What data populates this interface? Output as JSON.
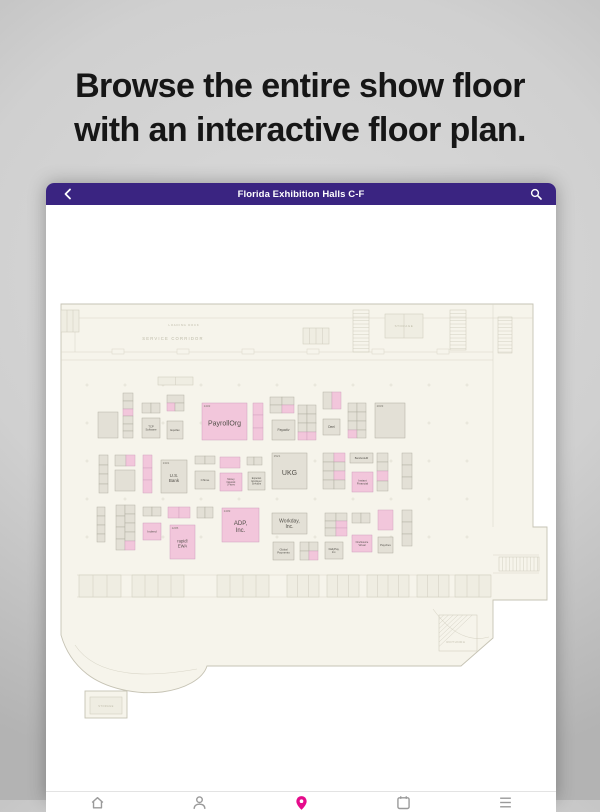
{
  "marketing": {
    "headline_line1": "Browse the entire show floor",
    "headline_line2": "with an interactive floor plan."
  },
  "app": {
    "title": "Florida Exhibition Halls C-F",
    "header_color": "#3a2481"
  },
  "bottom_nav": {
    "items": [
      {
        "name": "home",
        "active": false
      },
      {
        "name": "profile",
        "active": false
      },
      {
        "name": "map-pin",
        "active": true
      },
      {
        "name": "schedule",
        "active": false
      },
      {
        "name": "more",
        "active": false
      }
    ],
    "active_color": "#e50c8b",
    "inactive_color": "#9a9a9a"
  },
  "floorplan": {
    "colors": {
      "floor": "#f6f4eb",
      "wall": "#c6c3b4",
      "inner_line": "#d9d6c8",
      "room_line": "#cfccbd",
      "booth_gray": "#e3e0d6",
      "booth_gray_stroke": "#aeab9f",
      "booth_pink": "#f2c6db",
      "booth_pink_stroke": "#cf9fbd",
      "booth_text": "#53504a",
      "num_text": "#78756c",
      "corridor_text": "#bdbaa8"
    },
    "outline": "M 4 7 L 476 7 L 476 230 L 490 230 L 490 303 L 436 303 L 436 341 L 404 369 L 150 369 C 146 382 128 392 105 395 C 78 398 48 391 30 377 C 16 366 8 352 4 338 Z",
    "leg": {
      "x": 28,
      "y": 394,
      "w": 42,
      "h": 27
    },
    "lines": [
      {
        "x1": 4,
        "y1": 21,
        "x2": 476,
        "y2": 21
      },
      {
        "x1": 4,
        "y1": 55,
        "x2": 436,
        "y2": 55
      },
      {
        "x1": 4,
        "y1": 63,
        "x2": 436,
        "y2": 63
      },
      {
        "x1": 436,
        "y1": 7,
        "x2": 436,
        "y2": 230
      },
      {
        "x1": 18,
        "y1": 21,
        "x2": 18,
        "y2": 55
      },
      {
        "x1": 20,
        "y1": 278,
        "x2": 434,
        "y2": 278
      },
      {
        "x1": 20,
        "y1": 300,
        "x2": 434,
        "y2": 300
      },
      {
        "x1": 436,
        "y1": 258,
        "x2": 482,
        "y2": 258
      },
      {
        "x1": 436,
        "y1": 276,
        "x2": 482,
        "y2": 276
      }
    ],
    "doors": [
      {
        "x": 55,
        "y": 52
      },
      {
        "x": 120,
        "y": 52
      },
      {
        "x": 185,
        "y": 52
      },
      {
        "x": 250,
        "y": 52
      },
      {
        "x": 315,
        "y": 52
      },
      {
        "x": 380,
        "y": 52
      }
    ],
    "rooms": [
      {
        "x": 4,
        "y": 13,
        "w": 18,
        "h": 22,
        "sub": 2
      },
      {
        "x": 101,
        "y": 80,
        "w": 35,
        "h": 8,
        "sub": 1
      },
      {
        "x": 246,
        "y": 31,
        "w": 26,
        "h": 16,
        "sub": 3
      },
      {
        "x": 328,
        "y": 17,
        "w": 38,
        "h": 24,
        "sub": 1
      },
      {
        "x": 22,
        "y": 278,
        "w": 42,
        "h": 22,
        "sub": 2
      },
      {
        "x": 75,
        "y": 278,
        "w": 52,
        "h": 22,
        "sub": 3
      },
      {
        "x": 160,
        "y": 278,
        "w": 52,
        "h": 22,
        "sub": 3
      },
      {
        "x": 230,
        "y": 278,
        "w": 32,
        "h": 22,
        "sub": 2
      },
      {
        "x": 270,
        "y": 278,
        "w": 32,
        "h": 22,
        "sub": 2
      },
      {
        "x": 310,
        "y": 278,
        "w": 42,
        "h": 22,
        "sub": 3
      },
      {
        "x": 360,
        "y": 278,
        "w": 32,
        "h": 22,
        "sub": 2
      },
      {
        "x": 398,
        "y": 278,
        "w": 36,
        "h": 22,
        "sub": 2
      },
      {
        "x": 33,
        "y": 400,
        "w": 32,
        "h": 17,
        "sub": 0
      }
    ],
    "stairs": [
      {
        "x": 296,
        "y": 13,
        "w": 16,
        "h": 42,
        "dir": "h",
        "step": 3.5
      },
      {
        "x": 441,
        "y": 20,
        "w": 14,
        "h": 36,
        "dir": "h",
        "step": 3.5
      },
      {
        "x": 393,
        "y": 13,
        "w": 16,
        "h": 40,
        "dir": "h",
        "step": 3.5
      },
      {
        "x": 442,
        "y": 260,
        "w": 40,
        "h": 14,
        "dir": "v",
        "step": 3.5
      },
      {
        "x": 382,
        "y": 318,
        "w": 38,
        "h": 36,
        "dir": "d",
        "step": 5
      }
    ],
    "arcs": [
      "M 18 348 Q 45 389 140 372",
      "M 376 312 Q 402 348 432 340"
    ],
    "columns": {
      "xs": [
        30,
        68,
        106,
        144,
        182,
        220,
        258,
        296,
        334,
        372,
        410
      ],
      "ys": [
        88,
        126,
        164,
        202,
        240
      ]
    },
    "corridor_labels": [
      {
        "t": "LOADING DOCK",
        "x": 127,
        "y": 29,
        "fs": 2.8,
        "ls": 0.8
      },
      {
        "t": "SERVICE CORRIDOR",
        "x": 116,
        "y": 43,
        "fs": 4.2,
        "ls": 1.2
      },
      {
        "t": "STORAGE",
        "x": 347,
        "y": 30,
        "fs": 3,
        "ls": 0.6
      },
      {
        "t": "ROTUNDA",
        "x": 399,
        "y": 346,
        "fs": 3,
        "ls": 0.6
      },
      {
        "t": "STORAGE",
        "x": 49,
        "y": 410,
        "fs": 2.6,
        "ls": 0.4
      }
    ],
    "booths": [
      {
        "num": "1432",
        "label": "PayrollOrg",
        "lines": [
          "PayrollOrg"
        ],
        "x": 145,
        "y": 106,
        "w": 45,
        "h": 37,
        "color": "pink",
        "fs": 7
      },
      {
        "num": "1521",
        "label": "UKG",
        "lines": [
          "UKG"
        ],
        "x": 215,
        "y": 156,
        "w": 35,
        "h": 36,
        "color": "gray",
        "fs": 7
      },
      {
        "num": "1409",
        "label": "ADP, Inc.",
        "lines": [
          "ADP,",
          "Inc."
        ],
        "x": 165,
        "y": 211,
        "w": 37,
        "h": 34,
        "color": "pink",
        "fs": 6
      },
      {
        "num": "1331",
        "label": "U.S. Bank",
        "lines": [
          "U.S.",
          "Bank"
        ],
        "x": 104,
        "y": 163,
        "w": 26,
        "h": 33,
        "color": "gray",
        "fs": 4.5
      },
      {
        "num": "1205",
        "label": "rapid! EWA",
        "lines": [
          "rapid!",
          "EWA"
        ],
        "x": 113,
        "y": 228,
        "w": 25,
        "h": 34,
        "color": "pink",
        "fs": 4.2
      },
      {
        "num": "2033",
        "label": "",
        "lines": [],
        "x": 318,
        "y": 106,
        "w": 30,
        "h": 35,
        "color": "gray",
        "fs": 3
      },
      {
        "num": "",
        "label": "TCP Software",
        "lines": [
          "TCP",
          "Software"
        ],
        "x": 85,
        "y": 121,
        "w": 18,
        "h": 20,
        "color": "gray",
        "fs": 2.8
      },
      {
        "num": "",
        "label": "Equifax",
        "lines": [
          "Equifax"
        ],
        "x": 110,
        "y": 124,
        "w": 16,
        "h": 18,
        "color": "gray",
        "fs": 2.8
      },
      {
        "num": "",
        "label": "Payactiv",
        "lines": [
          "Payactiv"
        ],
        "x": 215,
        "y": 123,
        "w": 23,
        "h": 20,
        "color": "gray",
        "fs": 3.2
      },
      {
        "num": "",
        "label": "Deel",
        "lines": [
          "Deel"
        ],
        "x": 266,
        "y": 122,
        "w": 17,
        "h": 16,
        "color": "gray",
        "fs": 3.2
      },
      {
        "num": "",
        "label": "Chime",
        "lines": [
          "Chime"
        ],
        "x": 138,
        "y": 174,
        "w": 20,
        "h": 18,
        "color": "gray",
        "fs": 3
      },
      {
        "num": "",
        "label": "Money Network | Fiserv",
        "lines": [
          "Money",
          "Network",
          "| Fiserv"
        ],
        "x": 163,
        "y": 176,
        "w": 22,
        "h": 18,
        "color": "pink",
        "fs": 2.4
      },
      {
        "num": "",
        "label": "Experian Employer Services",
        "lines": [
          "Experian",
          "Employer",
          "Services"
        ],
        "x": 191,
        "y": 175,
        "w": 17,
        "h": 18,
        "color": "gray",
        "fs": 2.4
      },
      {
        "num": "",
        "label": "BambooHR",
        "lines": [
          "BambooHR"
        ],
        "x": 293,
        "y": 156,
        "w": 23,
        "h": 10,
        "color": "gray",
        "fs": 2.6
      },
      {
        "num": "",
        "label": "Instant Financial",
        "lines": [
          "Instant",
          "Financial"
        ],
        "x": 295,
        "y": 175,
        "w": 21,
        "h": 20,
        "color": "pink",
        "fs": 2.8
      },
      {
        "num": "",
        "label": "Indeed",
        "lines": [
          "Indeed"
        ],
        "x": 86,
        "y": 226,
        "w": 18,
        "h": 17,
        "color": "pink",
        "fs": 3
      },
      {
        "num": "",
        "label": "Workday, Inc.",
        "lines": [
          "Workday,",
          "Inc."
        ],
        "x": 215,
        "y": 216,
        "w": 35,
        "h": 21,
        "color": "gray",
        "fs": 5
      },
      {
        "num": "",
        "label": "Global Payments",
        "lines": [
          "Global",
          "Payments"
        ],
        "x": 216,
        "y": 245,
        "w": 21,
        "h": 18,
        "color": "gray",
        "fs": 2.8
      },
      {
        "num": "",
        "label": "OneSource Virtual",
        "lines": [
          "OneSource",
          "Virtual"
        ],
        "x": 295,
        "y": 238,
        "w": 20,
        "h": 17,
        "color": "pink",
        "fs": 2.5
      },
      {
        "num": "",
        "label": "DailyPay, Inc.",
        "lines": [
          "DailyPay,",
          "Inc."
        ],
        "x": 268,
        "y": 245,
        "w": 18,
        "h": 17,
        "color": "gray",
        "fs": 2.6
      },
      {
        "num": "",
        "label": "Paychex",
        "lines": [
          "Paychex"
        ],
        "x": 321,
        "y": 240,
        "w": 15,
        "h": 16,
        "color": "gray",
        "fs": 2.8
      }
    ],
    "cells": [
      [
        66,
        96,
        10,
        8,
        "g"
      ],
      [
        66,
        104,
        10,
        8,
        "g"
      ],
      [
        66,
        112,
        10,
        7,
        "p"
      ],
      [
        66,
        119,
        10,
        8,
        "g"
      ],
      [
        66,
        127,
        10,
        7,
        "g"
      ],
      [
        66,
        134,
        10,
        7,
        "g"
      ],
      [
        41,
        115,
        20,
        26,
        "g"
      ],
      [
        85,
        106,
        9,
        10,
        "g"
      ],
      [
        94,
        106,
        9,
        10,
        "g"
      ],
      [
        110,
        98,
        17,
        8,
        "g"
      ],
      [
        110,
        106,
        8,
        8,
        "p"
      ],
      [
        118,
        106,
        9,
        8,
        "g"
      ],
      [
        196,
        106,
        10,
        12,
        "p"
      ],
      [
        196,
        118,
        10,
        13,
        "p"
      ],
      [
        196,
        131,
        10,
        12,
        "p"
      ],
      [
        213,
        100,
        12,
        8,
        "g"
      ],
      [
        225,
        100,
        12,
        8,
        "g"
      ],
      [
        213,
        108,
        12,
        8,
        "g"
      ],
      [
        225,
        108,
        12,
        8,
        "p"
      ],
      [
        241,
        108,
        9,
        9,
        "g"
      ],
      [
        250,
        108,
        9,
        9,
        "g"
      ],
      [
        241,
        117,
        9,
        9,
        "g"
      ],
      [
        250,
        117,
        9,
        9,
        "g"
      ],
      [
        241,
        126,
        9,
        9,
        "g"
      ],
      [
        250,
        126,
        9,
        9,
        "g"
      ],
      [
        241,
        135,
        9,
        8,
        "p"
      ],
      [
        250,
        135,
        9,
        8,
        "p"
      ],
      [
        266,
        95,
        9,
        17,
        "g"
      ],
      [
        275,
        95,
        9,
        17,
        "p"
      ],
      [
        291,
        106,
        9,
        9,
        "g"
      ],
      [
        300,
        106,
        9,
        9,
        "g"
      ],
      [
        291,
        115,
        9,
        9,
        "g"
      ],
      [
        300,
        115,
        9,
        9,
        "g"
      ],
      [
        291,
        124,
        9,
        9,
        "g"
      ],
      [
        300,
        124,
        9,
        9,
        "g"
      ],
      [
        291,
        133,
        9,
        8,
        "p"
      ],
      [
        300,
        133,
        9,
        8,
        "g"
      ],
      [
        42,
        158,
        9,
        10,
        "g"
      ],
      [
        42,
        168,
        9,
        9,
        "g"
      ],
      [
        42,
        177,
        9,
        10,
        "g"
      ],
      [
        42,
        187,
        9,
        9,
        "g"
      ],
      [
        58,
        158,
        11,
        11,
        "g"
      ],
      [
        69,
        158,
        9,
        11,
        "p"
      ],
      [
        58,
        173,
        20,
        21,
        "g"
      ],
      [
        86,
        158,
        9,
        13,
        "p"
      ],
      [
        86,
        171,
        9,
        12,
        "p"
      ],
      [
        86,
        183,
        9,
        13,
        "p"
      ],
      [
        138,
        159,
        10,
        8,
        "g"
      ],
      [
        148,
        159,
        10,
        8,
        "g"
      ],
      [
        163,
        160,
        20,
        11,
        "p"
      ],
      [
        190,
        160,
        7,
        8,
        "g"
      ],
      [
        197,
        160,
        8,
        8,
        "g"
      ],
      [
        266,
        156,
        11,
        9,
        "g"
      ],
      [
        277,
        156,
        11,
        9,
        "p"
      ],
      [
        266,
        165,
        11,
        9,
        "g"
      ],
      [
        277,
        165,
        11,
        9,
        "g"
      ],
      [
        266,
        174,
        11,
        9,
        "g"
      ],
      [
        277,
        174,
        11,
        9,
        "p"
      ],
      [
        266,
        183,
        11,
        9,
        "g"
      ],
      [
        277,
        183,
        11,
        9,
        "g"
      ],
      [
        320,
        156,
        11,
        9,
        "g"
      ],
      [
        320,
        165,
        11,
        9,
        "g"
      ],
      [
        320,
        174,
        11,
        10,
        "p"
      ],
      [
        320,
        184,
        11,
        10,
        "g"
      ],
      [
        345,
        156,
        10,
        12,
        "g"
      ],
      [
        345,
        168,
        10,
        12,
        "g"
      ],
      [
        345,
        180,
        10,
        12,
        "g"
      ],
      [
        40,
        210,
        8,
        9,
        "g"
      ],
      [
        40,
        219,
        8,
        9,
        "g"
      ],
      [
        40,
        228,
        8,
        9,
        "g"
      ],
      [
        40,
        237,
        8,
        8,
        "g"
      ],
      [
        59,
        208,
        9,
        11,
        "g"
      ],
      [
        59,
        219,
        9,
        11,
        "g"
      ],
      [
        59,
        230,
        9,
        12,
        "g"
      ],
      [
        59,
        242,
        9,
        11,
        "g"
      ],
      [
        68,
        208,
        10,
        9,
        "g"
      ],
      [
        68,
        217,
        10,
        9,
        "g"
      ],
      [
        68,
        226,
        10,
        9,
        "g"
      ],
      [
        68,
        235,
        10,
        9,
        "g"
      ],
      [
        68,
        244,
        10,
        9,
        "p"
      ],
      [
        86,
        210,
        9,
        9,
        "g"
      ],
      [
        95,
        210,
        9,
        9,
        "g"
      ],
      [
        111,
        210,
        11,
        11,
        "p"
      ],
      [
        122,
        210,
        11,
        11,
        "p"
      ],
      [
        140,
        210,
        8,
        11,
        "g"
      ],
      [
        148,
        210,
        8,
        11,
        "g"
      ],
      [
        268,
        216,
        11,
        8,
        "g"
      ],
      [
        279,
        216,
        11,
        8,
        "g"
      ],
      [
        268,
        224,
        11,
        7,
        "g"
      ],
      [
        279,
        224,
        11,
        7,
        "p"
      ],
      [
        268,
        231,
        11,
        8,
        "g"
      ],
      [
        279,
        231,
        11,
        8,
        "p"
      ],
      [
        295,
        216,
        9,
        10,
        "g"
      ],
      [
        304,
        216,
        9,
        10,
        "g"
      ],
      [
        321,
        213,
        15,
        20,
        "p"
      ],
      [
        243,
        245,
        9,
        9,
        "g"
      ],
      [
        252,
        245,
        9,
        9,
        "g"
      ],
      [
        243,
        254,
        9,
        9,
        "g"
      ],
      [
        252,
        254,
        9,
        9,
        "p"
      ],
      [
        345,
        213,
        10,
        12,
        "g"
      ],
      [
        345,
        225,
        10,
        12,
        "g"
      ],
      [
        345,
        237,
        10,
        12,
        "g"
      ]
    ]
  }
}
